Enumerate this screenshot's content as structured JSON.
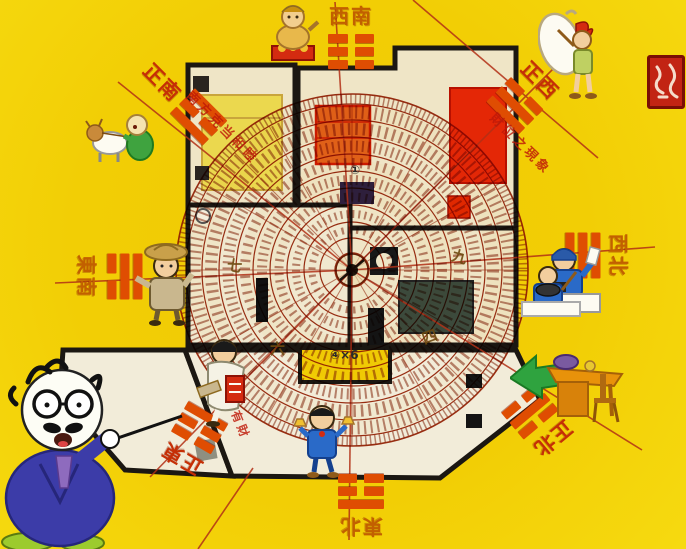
{
  "background_color": "#F1CD04",
  "directions": [
    {
      "id": "south",
      "label": "正南",
      "trigram_name": "li",
      "trigram": [
        1,
        0,
        1
      ]
    },
    {
      "id": "southwest",
      "label": "西南",
      "trigram_name": "kun",
      "trigram": [
        0,
        0,
        0
      ]
    },
    {
      "id": "west",
      "label": "正西",
      "trigram_name": "dui",
      "trigram": [
        0,
        1,
        1
      ]
    },
    {
      "id": "northwest",
      "label": "西北",
      "trigram_name": "qian",
      "trigram": [
        1,
        1,
        1
      ]
    },
    {
      "id": "southeast",
      "label": "東南",
      "trigram_name": "xun",
      "trigram": [
        1,
        1,
        0
      ]
    },
    {
      "id": "east",
      "label": "正東",
      "trigram_name": "zhen",
      "trigram": [
        0,
        0,
        1
      ]
    },
    {
      "id": "northeast",
      "label": "東北",
      "trigram_name": "gen",
      "trigram": [
        1,
        0,
        0
      ]
    },
    {
      "id": "north",
      "label": "正北",
      "trigram_name": "kan",
      "trigram": [
        0,
        1,
        0
      ]
    }
  ],
  "compass": {
    "numerals": [
      {
        "char": "七"
      },
      {
        "char": "九"
      },
      {
        "char": "四"
      },
      {
        "char": "六"
      }
    ],
    "circled_one": "①",
    "dimension_note": "④×6"
  },
  "annotations": [
    {
      "text": "南方克当和睦"
    },
    {
      "text": "財位之現象"
    },
    {
      "text": "有丁有財"
    }
  ],
  "colors": {
    "wall": "#1B1712",
    "label_red": "#C52F06",
    "label_orange": "#C26000",
    "trigram": "#DF4D02",
    "compass_ring": "#A03014",
    "accent_red": "#D42B10",
    "floor": "#EFE5C6"
  },
  "characters": [
    {
      "name": "feng-shui-master-professor"
    },
    {
      "name": "goat-and-green-boy"
    },
    {
      "name": "wealth-god"
    },
    {
      "name": "sack-carrier"
    },
    {
      "name": "farmer"
    },
    {
      "name": "clerk-at-counter"
    },
    {
      "name": "scholar-with-books"
    },
    {
      "name": "boy-with-gold-ingots"
    },
    {
      "name": "cook-at-stove"
    },
    {
      "name": "desk-and-chair-with-arrow"
    }
  ]
}
